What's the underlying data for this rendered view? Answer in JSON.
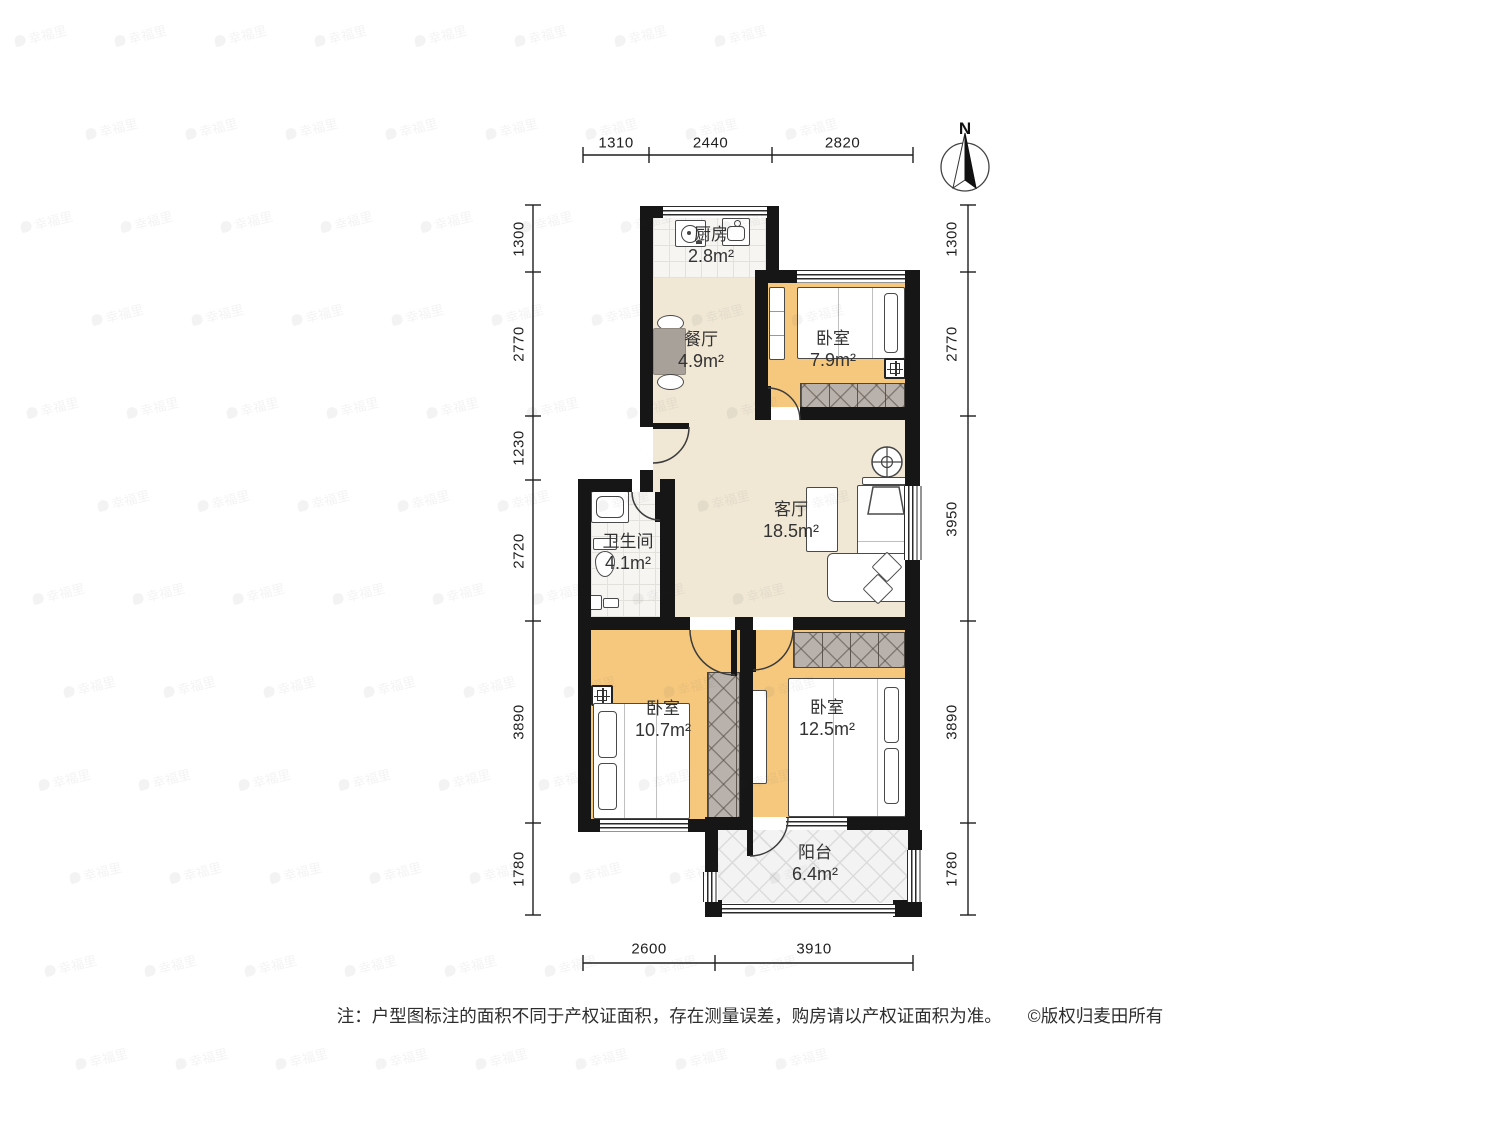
{
  "meta": {
    "compass_label": "N"
  },
  "rooms": [
    {
      "id": "kitchen",
      "name": "厨房",
      "area": "2.8m²"
    },
    {
      "id": "dining",
      "name": "餐厅",
      "area": "4.9m²"
    },
    {
      "id": "bedroom_top",
      "name": "卧室",
      "area": "7.9m²"
    },
    {
      "id": "living",
      "name": "客厅",
      "area": "18.5m²"
    },
    {
      "id": "bathroom",
      "name": "卫生间",
      "area": "4.1m²"
    },
    {
      "id": "bedroom_left",
      "name": "卧室",
      "area": "10.7m²"
    },
    {
      "id": "bedroom_right",
      "name": "卧室",
      "area": "12.5m²"
    },
    {
      "id": "balcony",
      "name": "阳台",
      "area": "6.4m²"
    }
  ],
  "dimensions": {
    "top": [
      "1310",
      "2440",
      "2820"
    ],
    "left": [
      "1300",
      "2770",
      "1230",
      "2720",
      "3890",
      "1780"
    ],
    "right": [
      "1300",
      "2770",
      "3950",
      "3890",
      "1780"
    ],
    "bottom": [
      "2600",
      "3910"
    ]
  },
  "footer": {
    "note": "注：户型图标注的面积不同于产权证面积，存在测量误差，购房请以产权证面积为准。",
    "copyright": "©版权归麦田所有"
  },
  "watermark": {
    "text": "幸福里"
  },
  "colors": {
    "wall": "#161616",
    "floor_wood": "#f5c87e",
    "floor_main": "#f0e7d5",
    "floor_tile": "#f6f5f2",
    "wardrobe_hatch": "#b9b1ab",
    "text": "#333333"
  }
}
